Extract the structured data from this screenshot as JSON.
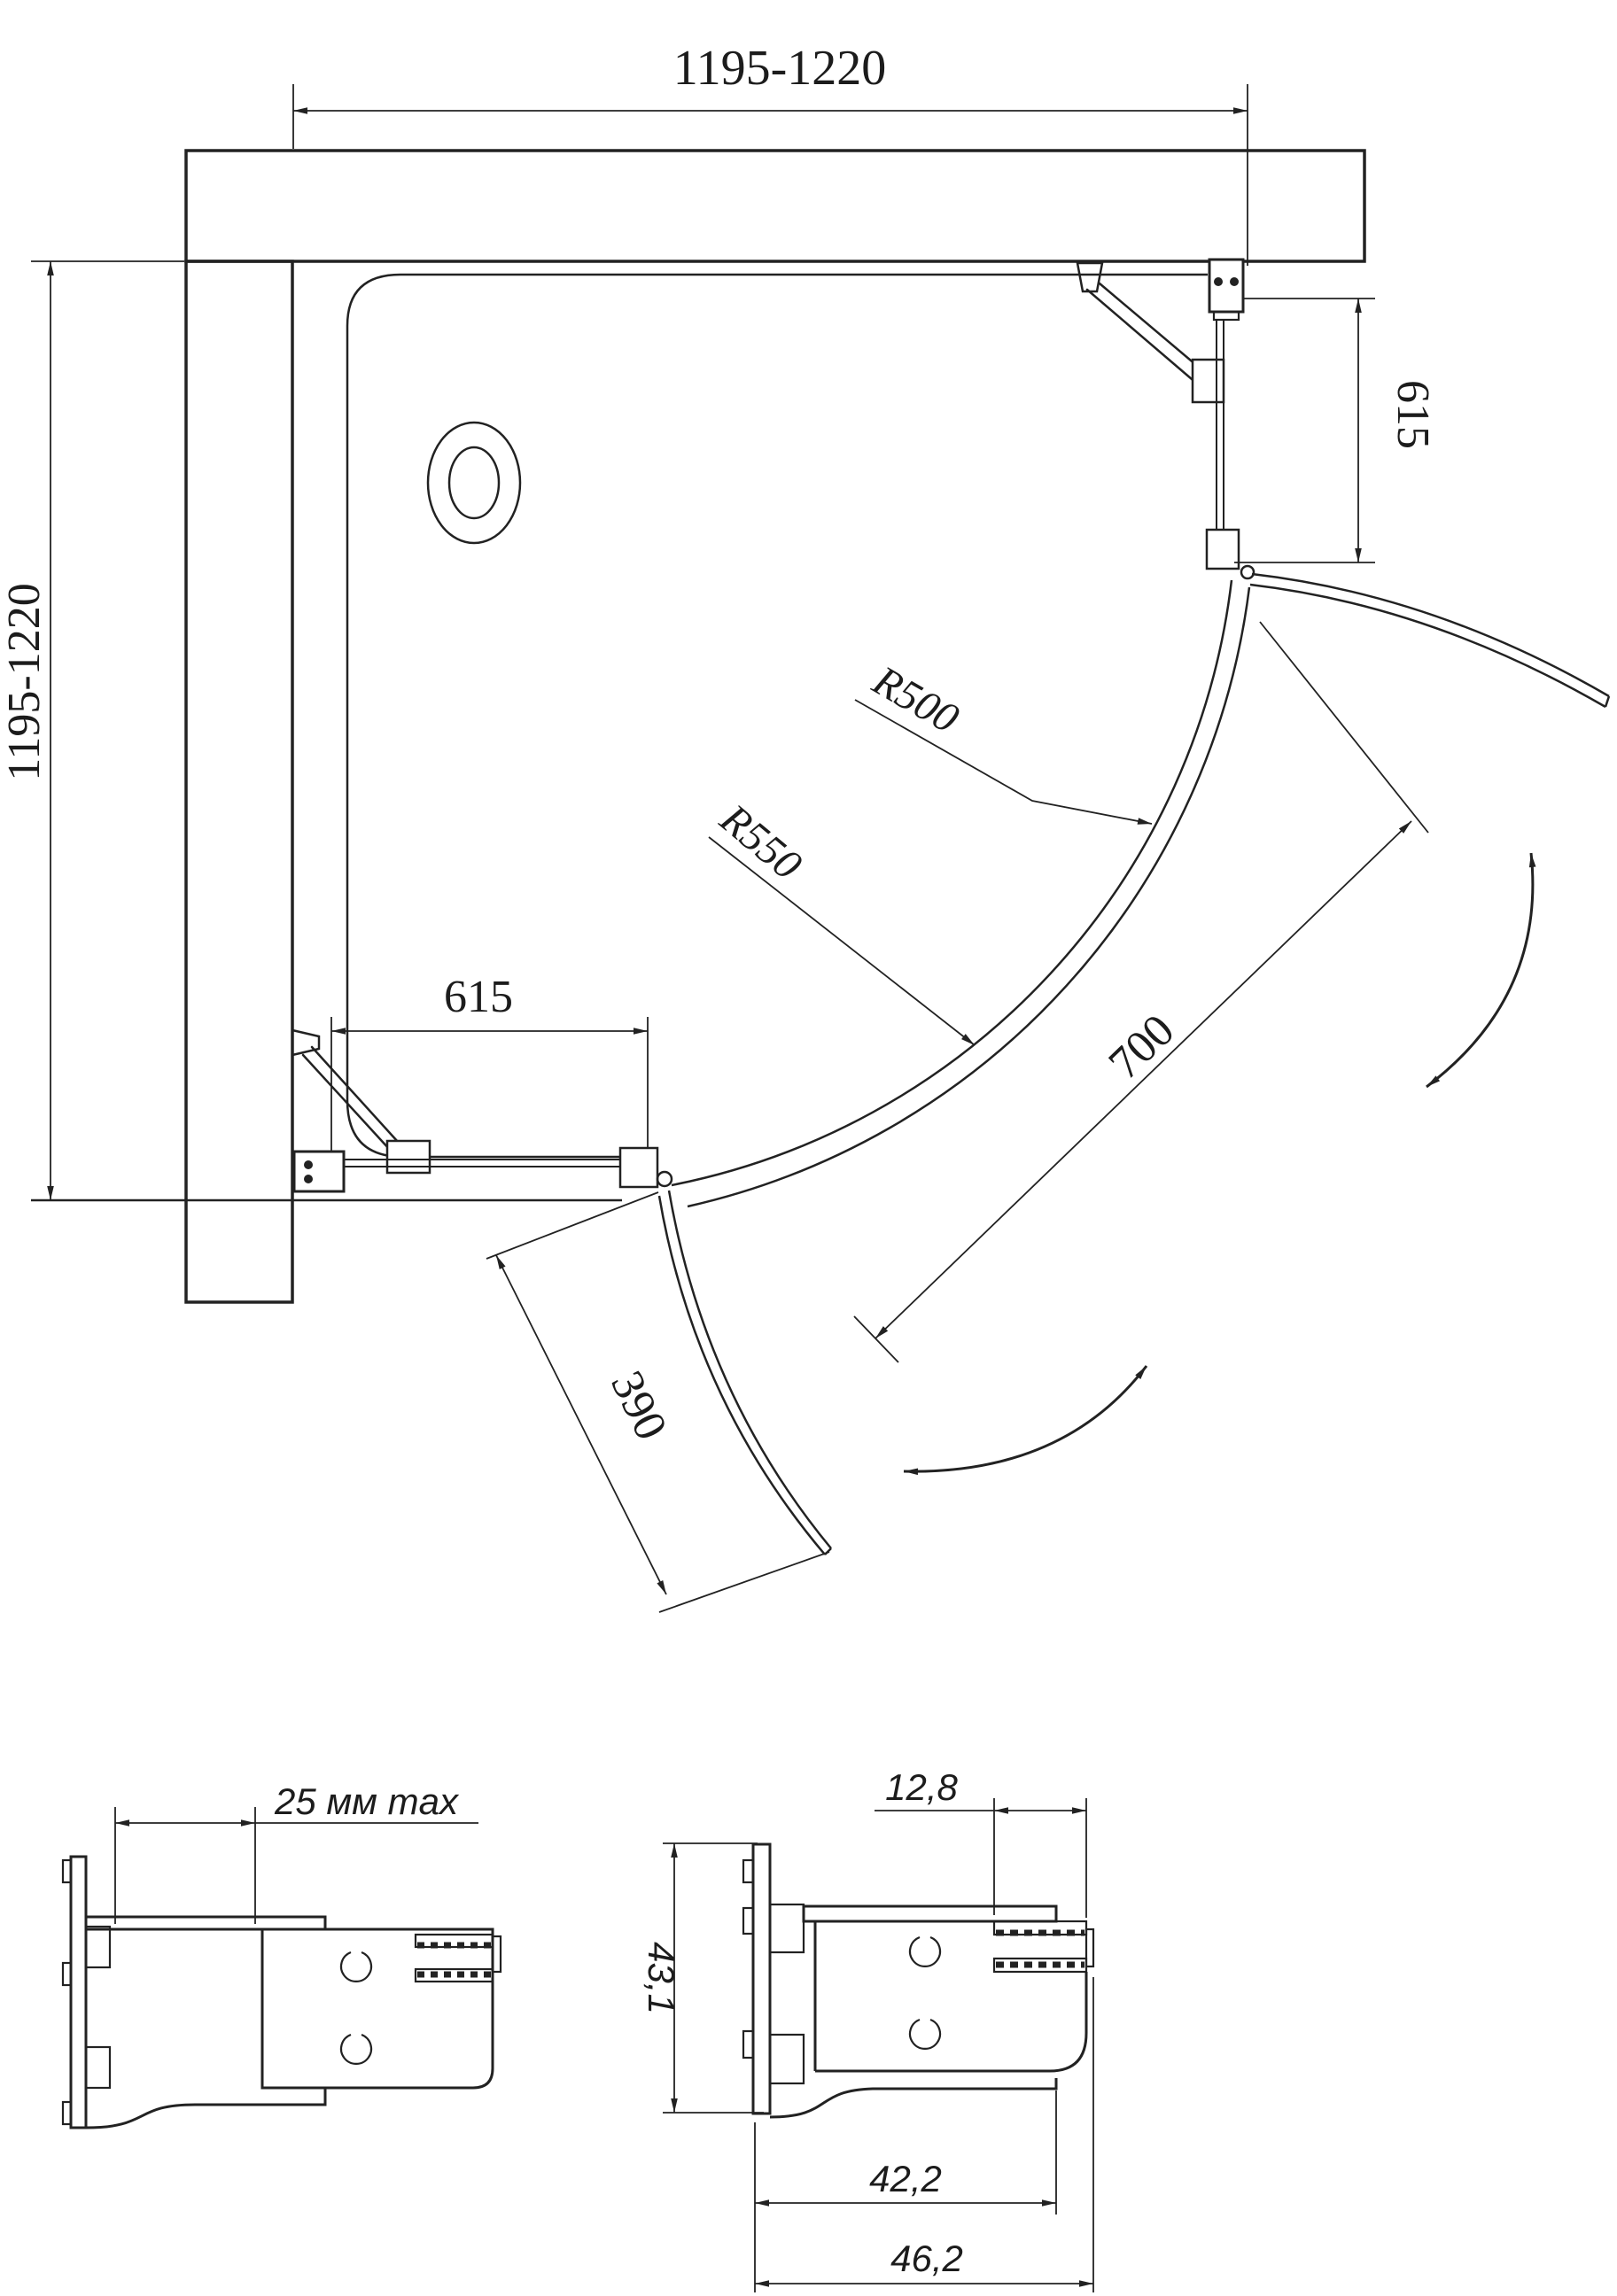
{
  "plan_view": {
    "dim_width_top": "1195-1220",
    "dim_depth_left": "1195-1220",
    "dim_fixed_panel_right": "615",
    "dim_fixed_panel_bottom": "615",
    "radius_inner_label": "R500",
    "radius_outer_label": "R550",
    "dim_door_opening": "700",
    "dim_door_leaf": "390"
  },
  "profile_details": {
    "left": {
      "dim_wall_adjustment": "25 мм max"
    },
    "right": {
      "dim_glass_channel": "12,8",
      "dim_profile_depth": "43,1",
      "dim_profile_width_inner": "42,2",
      "dim_profile_width_overall": "46,2"
    }
  }
}
